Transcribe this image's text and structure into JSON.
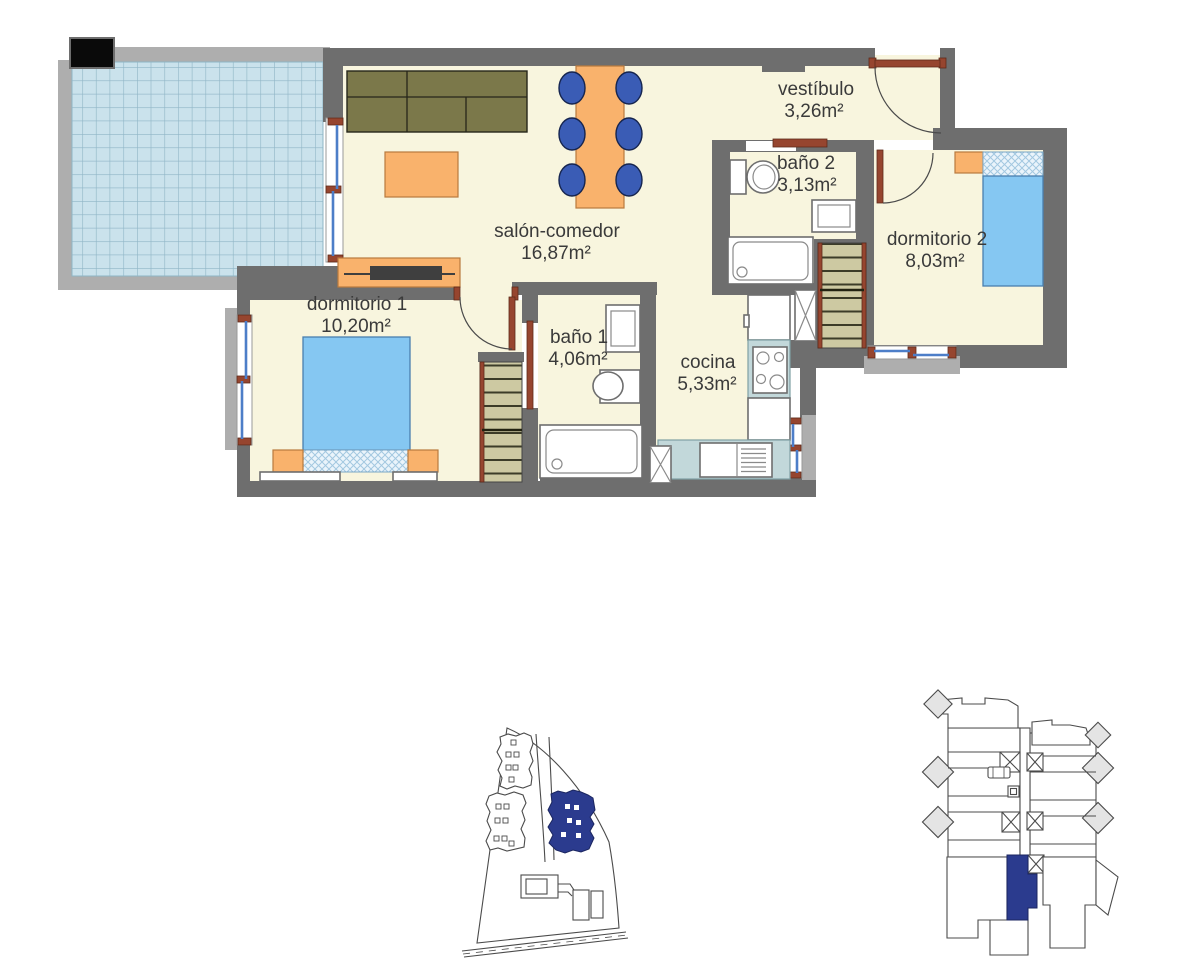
{
  "page": {
    "background": "#ffffff",
    "kind": "apartment-floor-plan-with-locator-maps"
  },
  "rooms": {
    "salon": {
      "name": "salón-comedor",
      "area": "16,87m²"
    },
    "vestibulo": {
      "name": "vestíbulo",
      "area": "3,26m²"
    },
    "bano2": {
      "name": "baño 2",
      "area": "3,13m²"
    },
    "dormitorio2": {
      "name": "dormitorio 2",
      "area": "8,03m²"
    },
    "dormitorio1": {
      "name": "dormitorio 1",
      "area": "10,20m²"
    },
    "bano1": {
      "name": "baño 1",
      "area": "4,06m²"
    },
    "cocina": {
      "name": "cocina",
      "area": "5,33m²"
    }
  },
  "colors": {
    "wall_dark": "#6e6e6e",
    "wall_light": "#aeaeae",
    "floor_cream": "#f8f5de",
    "terrace_tile": "#cae2ec",
    "terrace_grid": "#8fb5c6",
    "bed_blue": "#85c7f2",
    "furniture_orange": "#f9b26c",
    "sofa_olive": "#7b784a",
    "chair_blue": "#3a5cb5",
    "counter_teal": "#c2d8da",
    "door_brown": "#96452f",
    "window_glass": "#4d7ec8",
    "wardrobe_tan": "#cdc9a2",
    "highlight_navy": "#2b3b8e",
    "black_marker": "#0a0a0a"
  }
}
